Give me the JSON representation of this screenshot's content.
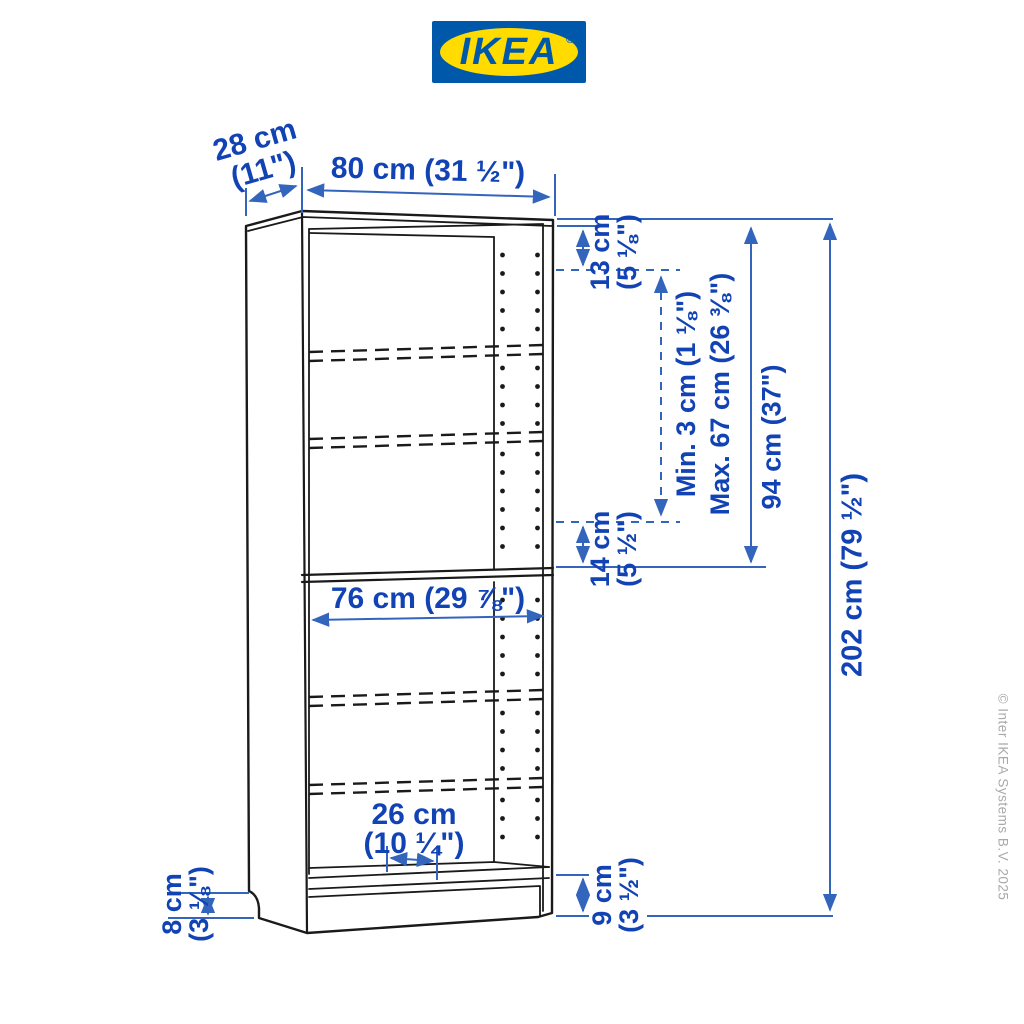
{
  "logo": {
    "text": "IKEA",
    "registered": "®"
  },
  "colors": {
    "ikea_blue": "#0058AB",
    "ikea_yellow": "#FFDB00",
    "dimension_text_blue": "#1243B5",
    "dimension_line_blue": "#3365BD",
    "drawing_black": "#1A1A1A",
    "copyright_gray": "#A9A9A9"
  },
  "dimensions": {
    "depth": {
      "line1": "28 cm",
      "line2": "(11\")"
    },
    "width": {
      "label": "80 cm (31 ½\")"
    },
    "top_to_first_shelf": {
      "line1": "13 cm",
      "line2": "(5 ⅛\")"
    },
    "shelf_adjustability": {
      "line1": "Min. 3 cm (1 ⅛\")",
      "line2": "Max. 67 cm (26 ⅜\")"
    },
    "upper_section_height": {
      "label": "94 cm (37\")"
    },
    "above_fixed_shelf": {
      "line1": "14 cm",
      "line2": "(5 ½\")"
    },
    "total_height": {
      "label": "202 cm (79 ½\")"
    },
    "inner_width": {
      "label": "76 cm (29 ⅞\")"
    },
    "bottom_shelf_depth": {
      "line1": "26 cm",
      "line2": "(10 ¼\")"
    },
    "plinth_left_height": {
      "line1": "8 cm",
      "line2": "(3 ⅛\")"
    },
    "plinth_right_height": {
      "line1": "9 cm",
      "line2": "(3 ½\")"
    }
  },
  "footer": {
    "copyright": "© Inter IKEA Systems B.V. 2025"
  }
}
